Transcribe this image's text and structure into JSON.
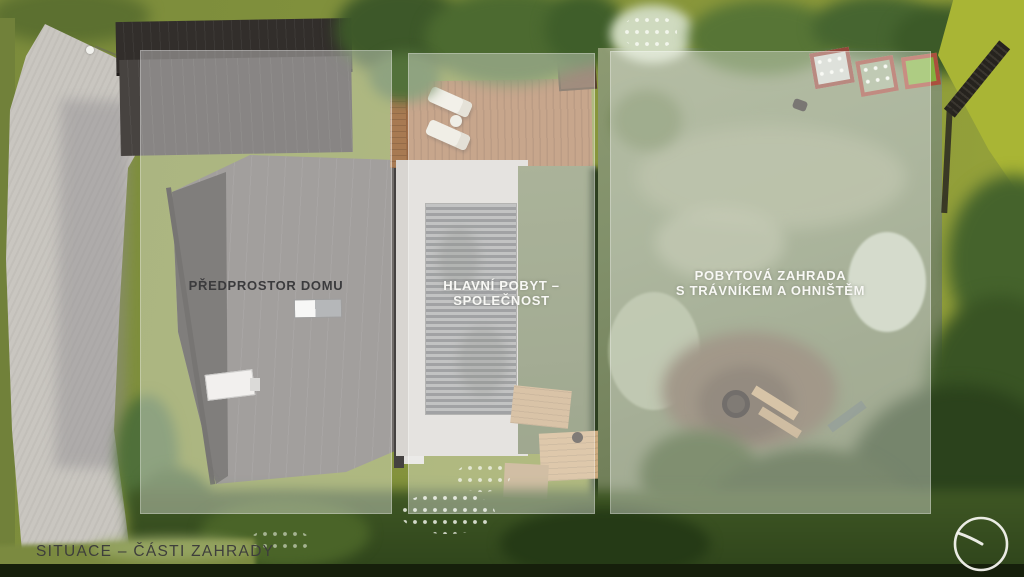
{
  "page": {
    "kind": "aerial landscape site plan render",
    "language": "cs"
  },
  "title": {
    "text": "SITUACE – ČÁSTI ZAHRADY",
    "color": "#3e3e3c"
  },
  "zones": [
    {
      "id": "predprostor-domu",
      "label": "PŘEDPROSTOR DOMU",
      "label_color": "#3b3b3d"
    },
    {
      "id": "hlavni-pobyt-spolecnost",
      "label": "HLAVNÍ POBYT – SPOLEČNOST",
      "label_color": "#f8f8f5"
    },
    {
      "id": "pobytova-zahrada",
      "label": "POBYTOVÁ ZAHRADA\nS TRÁVNÍKEM A OHNIŠTĚM",
      "label_color": "#f8f8f5"
    }
  ],
  "overlay": {
    "tint": "rgba(253,253,251,0.36)"
  },
  "logo": {
    "name": "circle-swoosh-logo",
    "stroke_color": "#f4f4ef"
  },
  "palette": {
    "grass": "#87953b",
    "dark_trees": "#33491f",
    "roof_dark": "#34302d",
    "roof_light": "#6f6b68",
    "driveway": "#c9c6c0",
    "deck_wood": "#aa764e",
    "fence": "#26231e",
    "raised_bed_border": "#9a4a3c"
  }
}
